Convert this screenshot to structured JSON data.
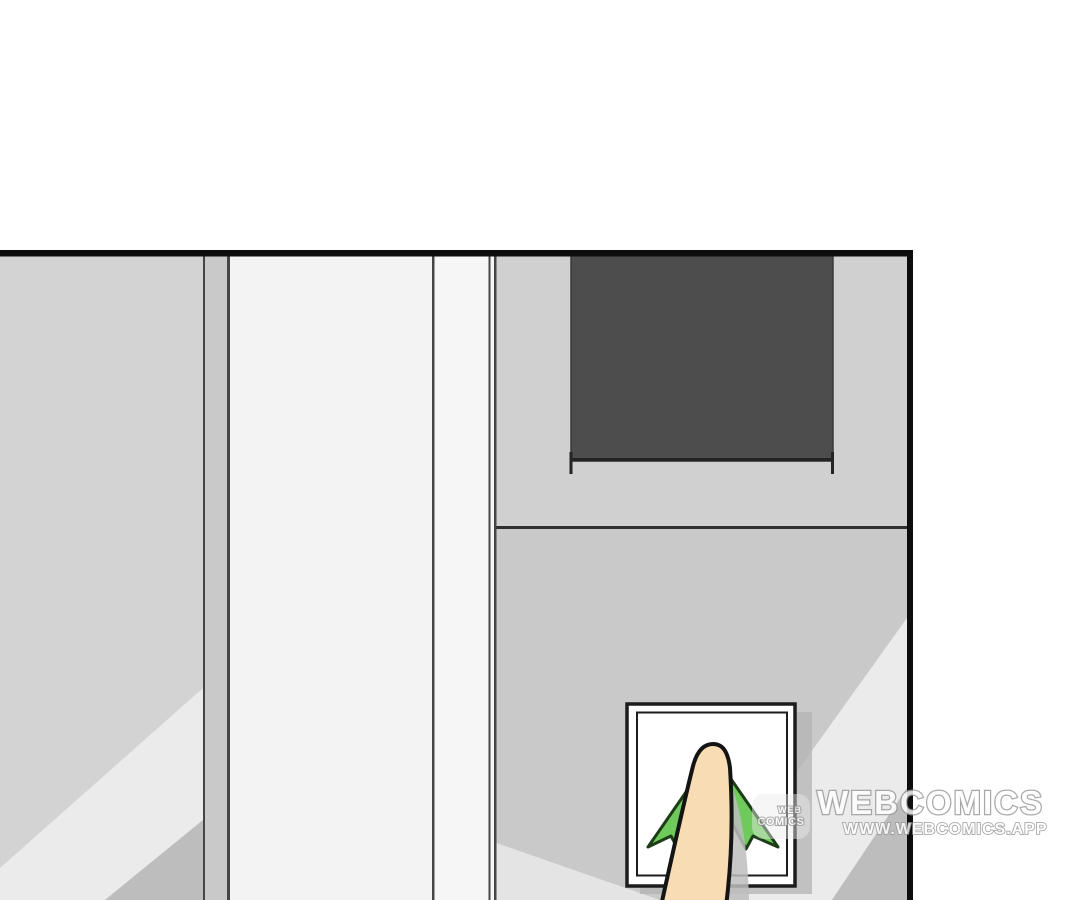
{
  "panel": {
    "kind": "comic-panel",
    "button_icon": "up-arrow"
  },
  "watermark": {
    "badge_top": "WEB",
    "badge_bottom": "COMICS",
    "title": "WEBCOMICS",
    "url": "WWW.WEBCOMICS.APP"
  },
  "colors": {
    "page_bg": "#ffffff",
    "panel_border": "#0d0d0d",
    "left_wall": "#d3d3d3",
    "wall_highlight_band": "#ebebeb",
    "wall_shade": "#bdbdbd",
    "pillar_strip": "#c9c9c9",
    "door_column": "#f3f3f3",
    "door_column_bright": "#f6f6f6",
    "frame_line": "#454545",
    "right_wall_upper": "#d0d0d0",
    "right_wall_lower": "#c9c9c9",
    "window_dark": "#4d4d4d",
    "window_edge": "#242424",
    "divider_line": "#303030",
    "button_face": "#ffffff",
    "button_outline": "#1c1c1c",
    "button_shadow": "#b3b3b3",
    "arrow_green": "#6ecb5b",
    "arrow_outline": "#1d3d18",
    "finger_skin": "#f8dcb4",
    "finger_outline": "#141414",
    "finger_shadow": "#bdbdbd",
    "watermark_fill": "#ffffff",
    "watermark_outline": "#979797"
  }
}
